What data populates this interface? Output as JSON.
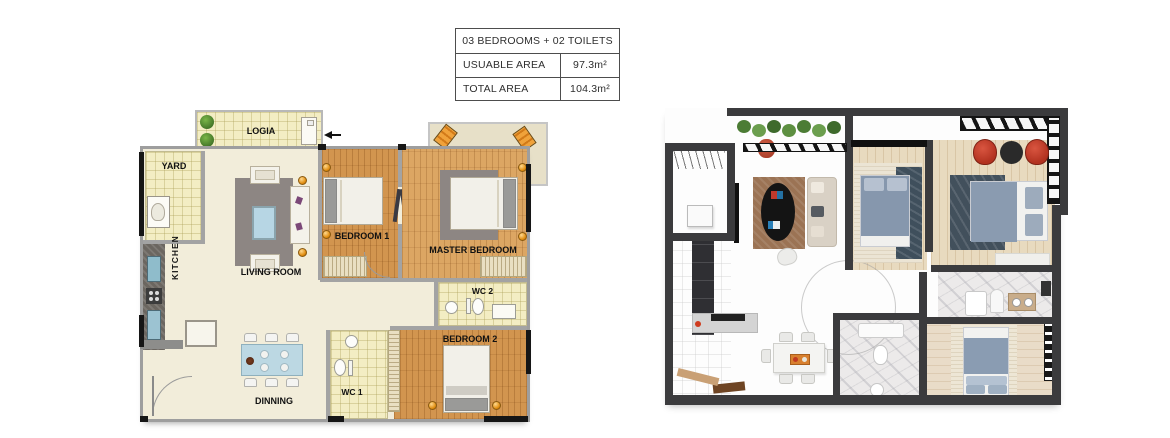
{
  "info_table": {
    "header": "03 BEDROOMS + 02 TOILETS",
    "rows": [
      {
        "label": "USUABLE AREA",
        "value": "97.3m²"
      },
      {
        "label": "TOTAL AREA",
        "value": "104.3m²"
      }
    ]
  },
  "floor_plan_2d": {
    "rooms": {
      "logia": "LOGIA",
      "yard": "YARD",
      "kitchen": "KITCHEN",
      "living_room": "LIVING ROOM",
      "bedroom_1": "BEDROOM 1",
      "master_bedroom": "MASTER BEDROOM",
      "wc_2": "WC 2",
      "bedroom_2": "BEDROOM 2",
      "wc_1": "WC 1",
      "dining": "DINNING"
    }
  },
  "colors": {
    "wall_gray": "#9e9e9e",
    "wall_black": "#161616",
    "floor_cream": "#f2edda",
    "tile_yellow": "#f3edc3",
    "wood_orange": "#d2954f",
    "rug_gray": "#8d8683",
    "lamp_gold": "#e08c0e",
    "lounge_chair_orange": "#f0a23a",
    "dining_table_blue": "#bcd8e3",
    "wall_dark_3d": "#3b3b3d",
    "bed_blue_3d": "#8697ad",
    "armchair_red_3d": "#b23220",
    "plant_green_3d": "#55813c",
    "living_rug_brown_3d": "#9b7354"
  }
}
